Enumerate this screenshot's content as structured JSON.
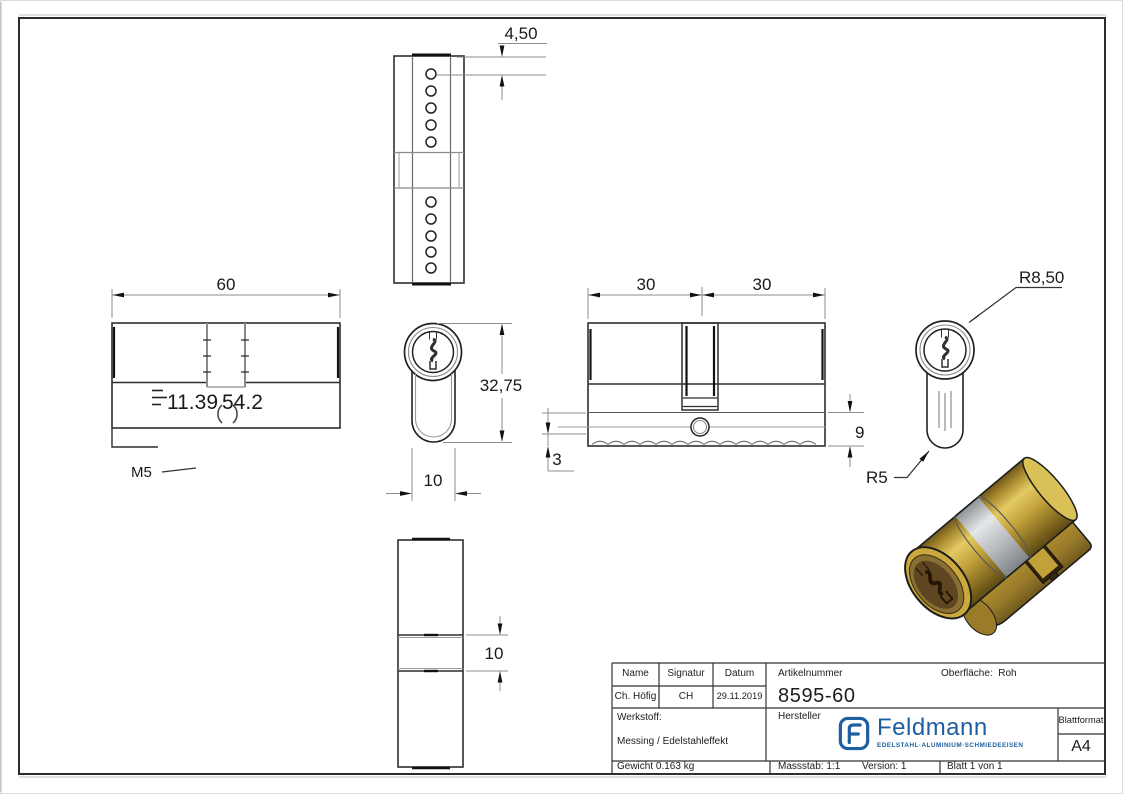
{
  "drawing_labels": {
    "pin_dim": "4,50",
    "length_dim": "60",
    "note_a": "11.39",
    "note_b": "54.2",
    "thread": "M5",
    "height_dim": "32,75",
    "width_dim": "10",
    "half_left_dim": "30",
    "half_right_dim": "30",
    "body_bottom_dim": "9",
    "foot_dim": "3",
    "radius_dim": "R8,50",
    "foot_radius_dim": "R5",
    "cam_width_dim": "10"
  },
  "title_block": {
    "name_label": "Name",
    "name_value": "Ch. Höfig",
    "signature_label": "Signatur",
    "signature_value": "CH",
    "date_label": "Datum",
    "date_value": "29.11.2019",
    "article_label": "Artikelnummer",
    "article_value": "8595-60",
    "surface_label": "Oberfläche:",
    "surface_value": "Roh",
    "material_label": "Werkstoff:",
    "material_value": "Messing / Edelstahleffekt",
    "manufacturer_label": "Hersteller",
    "format_label": "Blattformat",
    "format_value": "A4",
    "weight_text": "Gewicht 0.163 kg",
    "scale_text": "Massstab: 1:1",
    "version_text": "Version: 1",
    "sheet_text": "Blatt 1 von 1",
    "logo_brand": "Feldmann",
    "logo_tagline": "EDELSTAHL·ALUMINIUM·SCHMIEDEEISEN"
  },
  "colors": {
    "background": "#ffffff",
    "line": "#2f2f2f",
    "dim_line": "#8c8c8c",
    "logo_blue": "#1f5fa0",
    "brass": "#b5952f",
    "brass_light": "#ddc15c",
    "brass_dark": "#6e581c",
    "silver": "#c9cbcd",
    "face_brown": "#5f4623"
  }
}
